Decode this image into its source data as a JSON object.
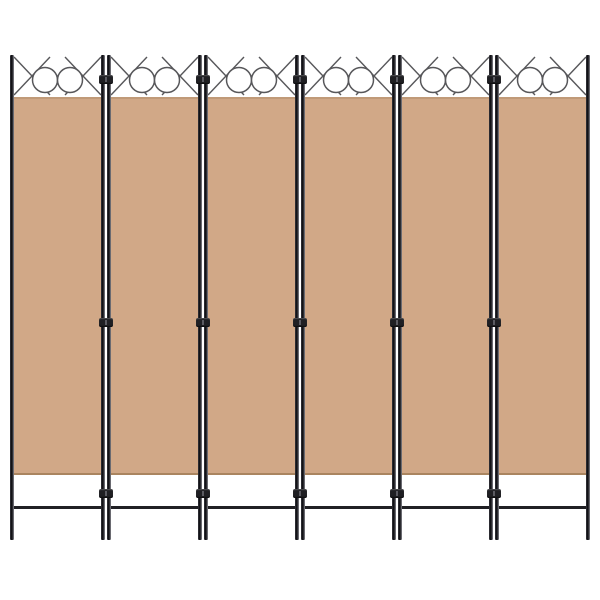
{
  "image": {
    "type": "product-photo",
    "subject": "6-panel folding room divider privacy screen with beige fabric panels and black metal frame",
    "background_color": "#ffffff"
  },
  "divider": {
    "panel_count": 6,
    "junction_count": 5,
    "hinges_per_junction": 3,
    "circles_per_panel": 2,
    "colors": {
      "fabric": "#d1a887",
      "fabric_edge_top": "#c09a78",
      "fabric_edge_bottom": "#aa8560",
      "frame": "#17171b",
      "frame_highlight": "#93939b",
      "ornament_stroke": "#57575a",
      "hinge": "#1f1f23",
      "foot_bar": "#202024",
      "background": "#ffffff"
    }
  }
}
